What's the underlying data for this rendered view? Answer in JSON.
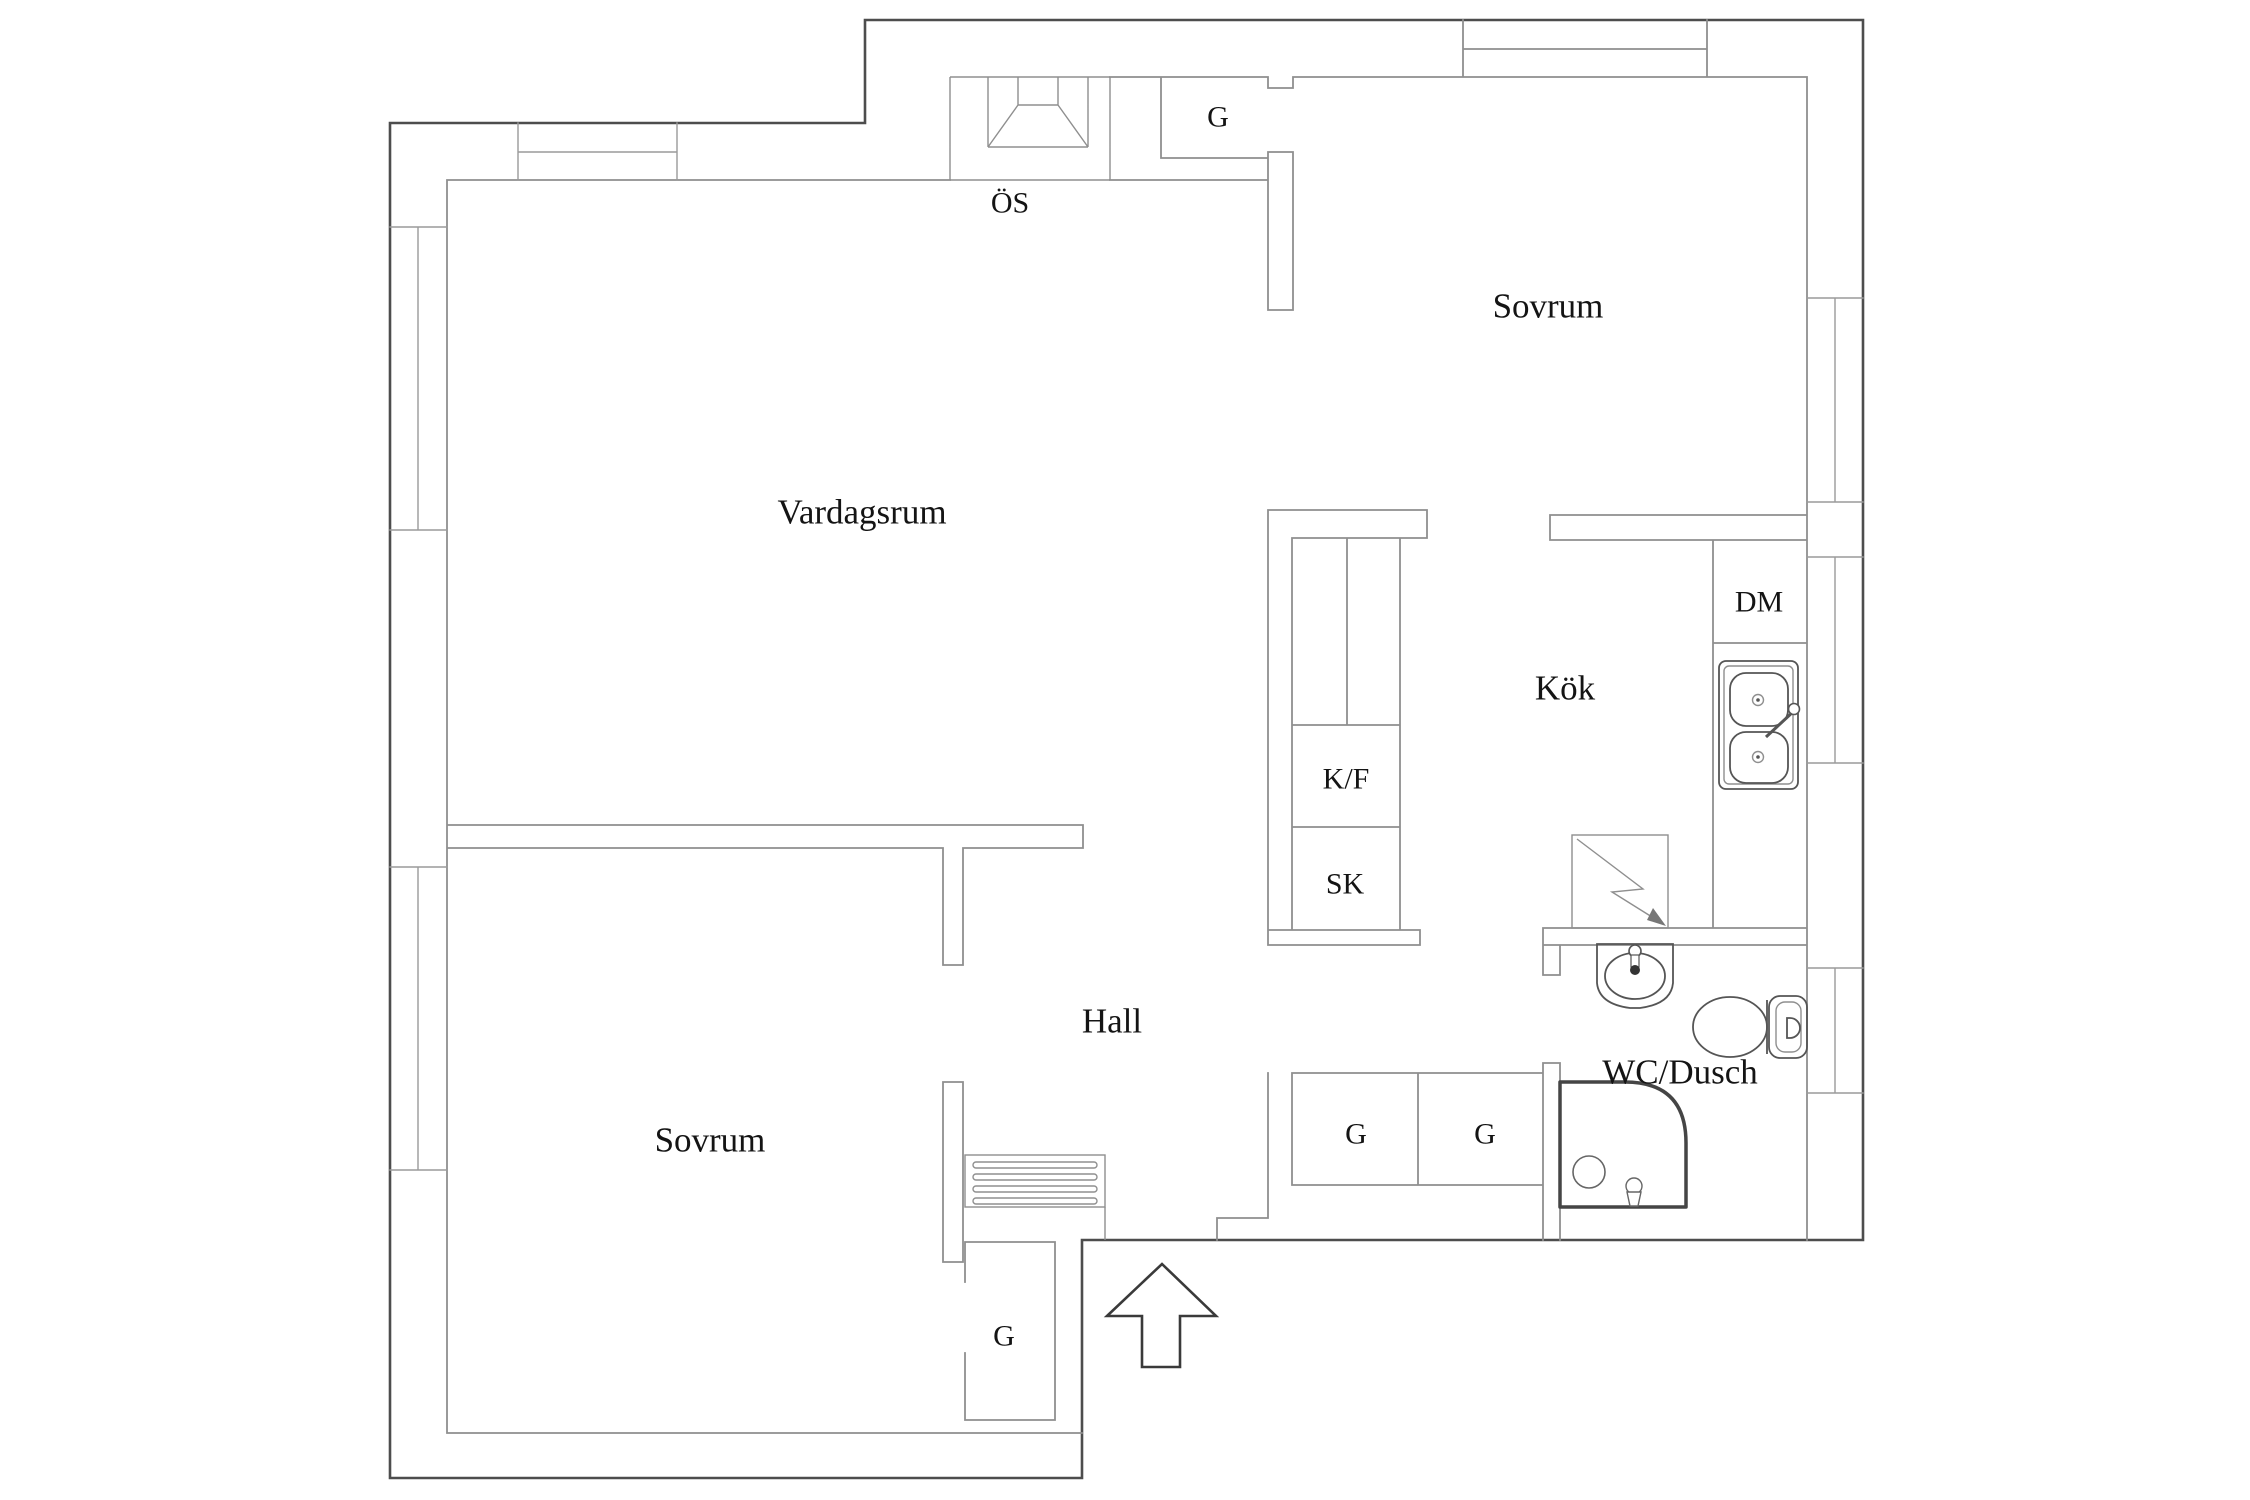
{
  "document": {
    "type": "apartment-floor-plan",
    "background_color": "#ffffff"
  },
  "labels": {
    "vardagsrum": "Vardagsrum",
    "sovrum_top": "Sovrum",
    "sovrum_bottom": "Sovrum",
    "kok": "Kök",
    "hall": "Hall",
    "wc_dusch": "WC/Dusch",
    "os": "ÖS",
    "g": "G",
    "kf": "K/F",
    "sk": "SK",
    "dm": "DM"
  },
  "icons": [
    "fireplace-icon",
    "wardrobe-icon",
    "fridge-freezer-icon",
    "cleaning-cabinet-icon",
    "dishwasher-icon",
    "kitchen-sink-icon",
    "stove-icon",
    "washbasin-icon",
    "toilet-icon",
    "shower-icon",
    "radiator-icon",
    "entrance-arrow-icon"
  ],
  "colors": {
    "wall_outer": "#4d4d4d",
    "wall_inner": "#8f8f8f",
    "fixture": "#555555",
    "text": "#141414",
    "background": "#ffffff"
  }
}
